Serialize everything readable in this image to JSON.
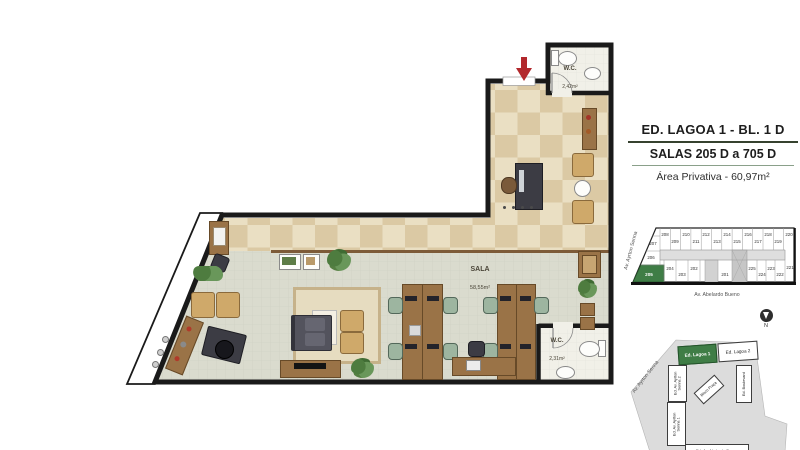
{
  "title_block": {
    "line1": "ED. LAGOA 1 - BL. 1 D",
    "line2": "SALAS 205 D a 705 D",
    "line3": "Área Privativa - 60,97m²"
  },
  "plan": {
    "sala_label": "SALA",
    "sala_area": "58,55m²",
    "wc_top_label": "W.C.",
    "wc_top_area": "2,42m²",
    "wc_bottom_label": "W.C.",
    "wc_bottom_area": "2,31m²"
  },
  "keyplan": {
    "street_left": "Av. Ayrton Senna",
    "street_bottom": "Av. Abelardo Bueno",
    "highlighted_unit": "205",
    "units_top": [
      "208",
      "209",
      "210",
      "211",
      "212",
      "213",
      "214",
      "215",
      "216",
      "217",
      "218",
      "219",
      "220"
    ],
    "units_left": [
      "207",
      "206",
      "205"
    ],
    "units_bottom_left": [
      "204",
      "203",
      "202",
      "201"
    ],
    "units_bottom_right": [
      "225",
      "224",
      "223",
      "222",
      "221"
    ]
  },
  "sitemap": {
    "street_label": "Av. Ayrton Senna",
    "compass_label": "N",
    "buildings": [
      {
        "name": "Ed. Lagoa 1",
        "highlighted": true
      },
      {
        "name": "Ed. Lagoa 2",
        "highlighted": false
      },
      {
        "name": "Ed. Av. Ayrton Senna 2",
        "highlighted": false
      },
      {
        "name": "Ed. Boulevard",
        "highlighted": false
      },
      {
        "name": "Bloco Praça",
        "highlighted": false
      },
      {
        "name": "Ed. Av. Ayrton Senna 1",
        "highlighted": false
      },
      {
        "name": "Ed. Av. Abelardo Bueno",
        "highlighted": false
      }
    ]
  },
  "colors": {
    "highlight_green": "#3f7d46",
    "entrance_arrow_red": "#b2282c",
    "wall_black": "#1a1a1a"
  }
}
